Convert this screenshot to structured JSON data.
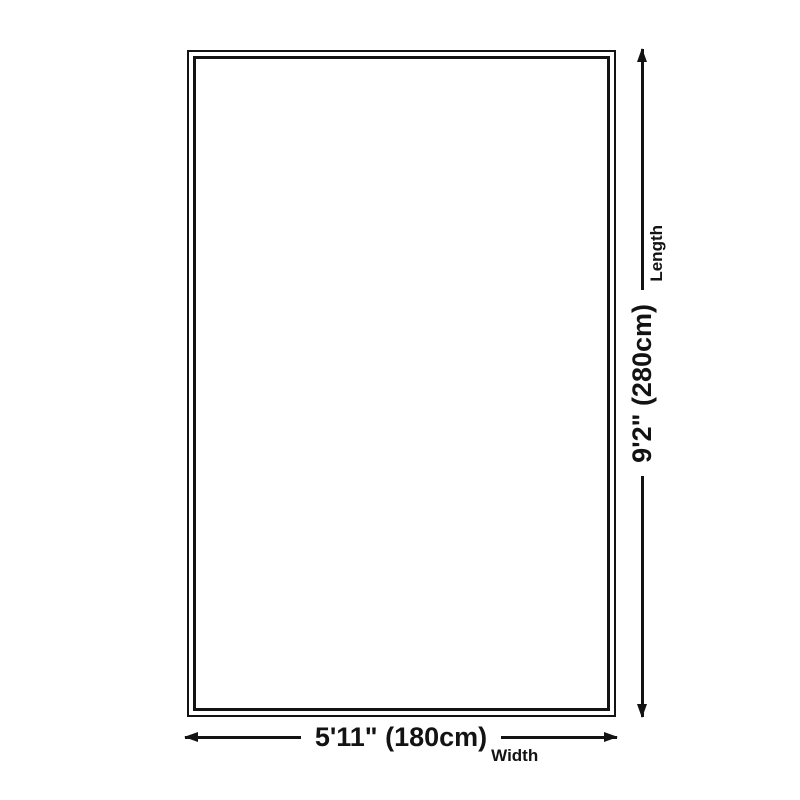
{
  "diagram": {
    "type": "product-dimension-diagram",
    "length": {
      "value": "9'2\" (280cm)",
      "label": "Length"
    },
    "width": {
      "value": "5'11\" (180cm)",
      "label": "Width"
    },
    "icons": {
      "length_arrow": "double-headed-vertical-arrow",
      "width_arrow": "double-headed-horizontal-arrow"
    },
    "colors": {
      "line": "#131313",
      "text": "#131313",
      "background": "#ffffff"
    }
  }
}
